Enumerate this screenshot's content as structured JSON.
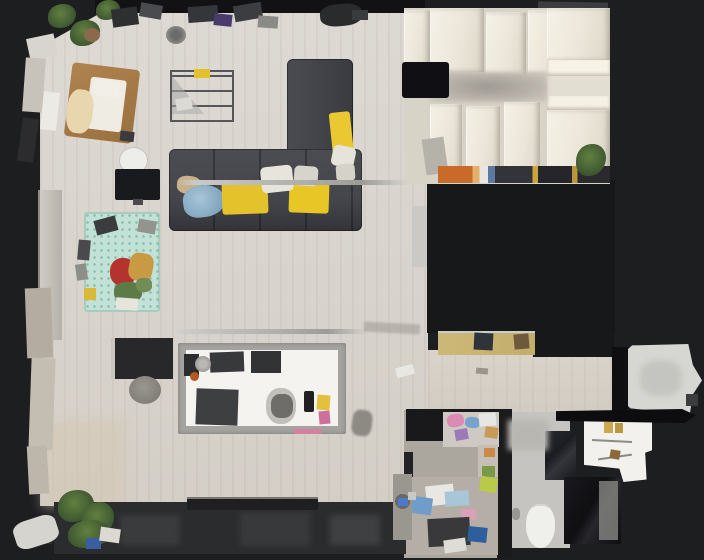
{
  "app": {
    "type": "3d-scan-floorplan-viewer",
    "description": "Top-down dollhouse floor plan view of a scanned studio apartment",
    "view_mode": "floorplan-top-down"
  },
  "canvas": {
    "width": 704,
    "height": 560,
    "background": "#1d1e20"
  },
  "palette": {
    "background": "#1d1e20",
    "wall_dark": "#131315",
    "unscanned_dark": "#17181a",
    "floor_wood": "#d8d4cd",
    "hallway_floor": "#d5cfc6",
    "closet_panel_white": "#ece7da",
    "sofa_gray": "#45464b",
    "accent_yellow": "#e7c52a",
    "blanket_blue": "#8fb3c9",
    "teal_bed": "#c2e2d8",
    "bed_wood_brown": "#a5794a",
    "island_frame_gray": "#a5a39f",
    "island_top_white": "#f4f3f0",
    "cabinet_tan": "#c9b272",
    "bathroom_tile": "#c6c4c0",
    "balcony_band": "#2b2c2e",
    "rail_silver": "#b5b6b2"
  },
  "rooms": [
    {
      "id": "living-room"
    },
    {
      "id": "closet-room"
    },
    {
      "id": "kitchen"
    },
    {
      "id": "hallway"
    },
    {
      "id": "laundry-storage-room"
    },
    {
      "id": "bathroom"
    },
    {
      "id": "right-balcony"
    },
    {
      "id": "bottom-balcony"
    }
  ],
  "objects": [
    "bed",
    "wire-shelf-rack",
    "l-shaped-sofa",
    "yellow-throws",
    "blue-blanket",
    "curtain-rail",
    "tv-screen",
    "round-side-table",
    "teal-floral-daybed",
    "desk",
    "stool",
    "kitchen-island",
    "sink",
    "stove-mats",
    "wall-cabinet-tan",
    "wardrobe-panels",
    "wall-tv",
    "book-strip",
    "plants",
    "toilet",
    "shower",
    "vanity-counter",
    "washing-machine",
    "laundry-clutter",
    "window-sill"
  ]
}
